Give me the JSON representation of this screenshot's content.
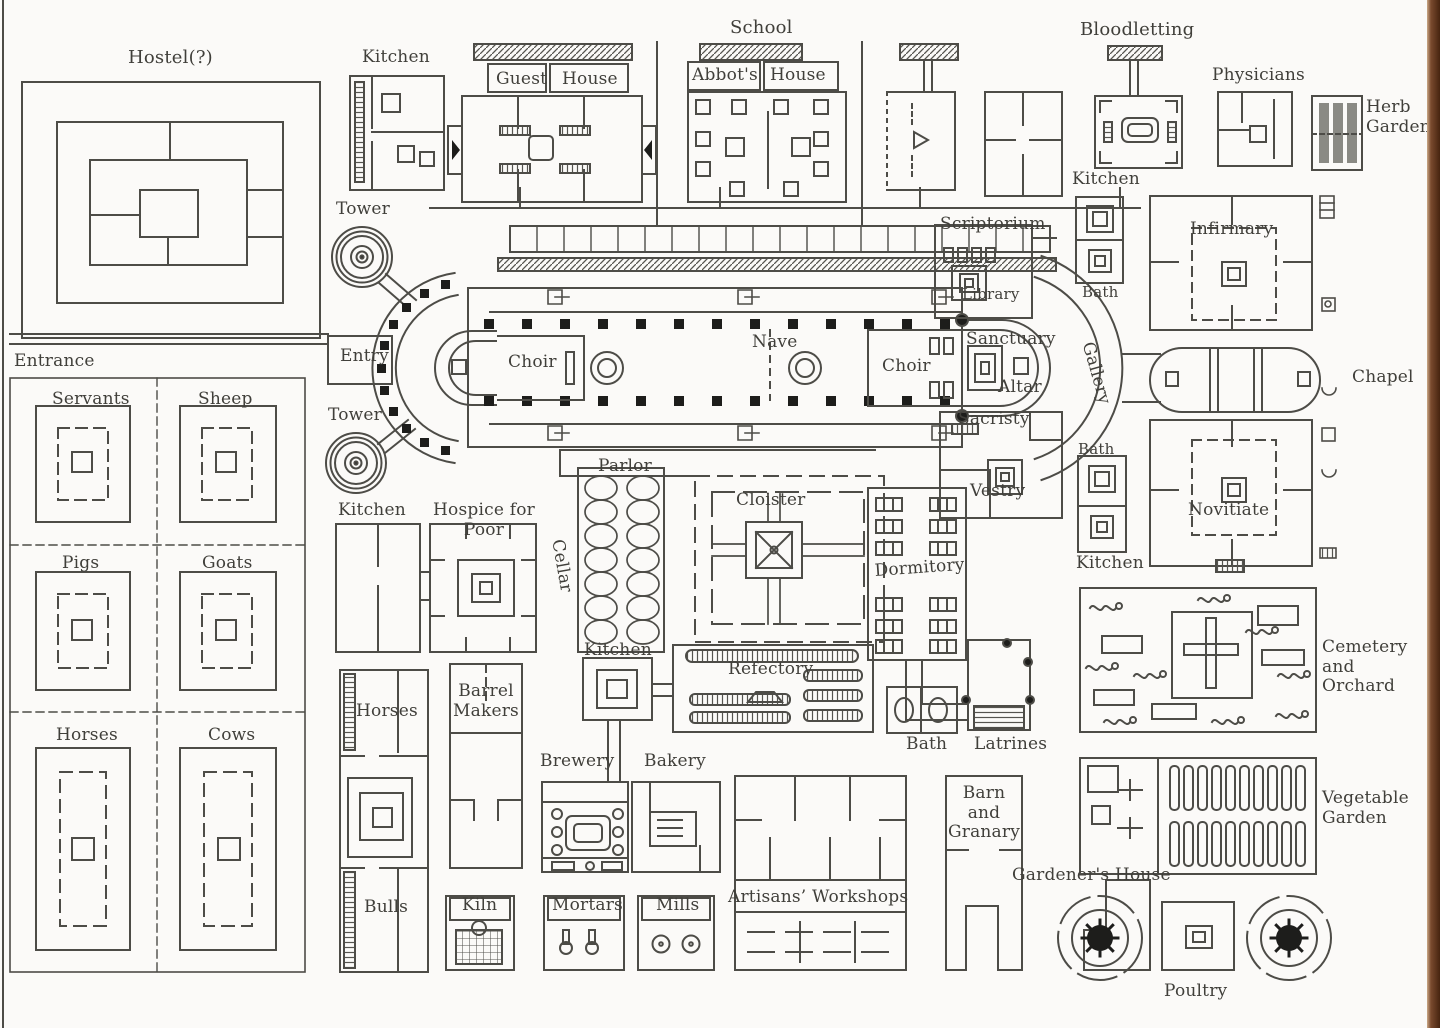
{
  "page": {
    "title": "Plan of a medieval monastery (Plan of Saint Gall)"
  },
  "colors": {
    "background": "#fbfaf8",
    "line": "#4d4c47",
    "label": "#403f3a",
    "solid_fill": "#1d1d1b",
    "edge_bar": "#46240f"
  },
  "labels": {
    "hostel": "Hostel(?)",
    "kitchen_tl": "Kitchen",
    "guest": "Guest",
    "guest_house": "House",
    "school": "School",
    "abbots": "Abbot's",
    "abbots_house": "House",
    "bloodletting": "Bloodletting",
    "physicians": "Physicians",
    "herb_garden": "Herb\nGarden",
    "kitchen_tr": "Kitchen",
    "scriptorium": "Scriptorium",
    "library": "Library",
    "bath1": "Bath",
    "infirmary": "Infirmary",
    "tower1": "Tower",
    "entry": "Entry",
    "tower2": "Tower",
    "entrance": "Entrance",
    "choir_w": "Choir",
    "nave": "Nave",
    "choir_e": "Choir",
    "sanctuary": "Sanctuary",
    "altar": "Altar",
    "gallery": "Gallery",
    "chapel": "Chapel",
    "sacristy": "Sacristy",
    "vestry": "Vestry",
    "bath2": "Bath",
    "novitiate": "Novitiate",
    "kitchen_r": "Kitchen",
    "servants": "Servants",
    "sheep": "Sheep",
    "pigs": "Pigs",
    "goats": "Goats",
    "horses_pen": "Horses",
    "cows": "Cows",
    "kitchen_l": "Kitchen",
    "hospice": "Hospice for\nPoor",
    "parlor": "Parlor",
    "cellar": "Cellar",
    "cloister": "Cloister",
    "dormitory": "Dormitory",
    "kitchen_m": "Kitchen",
    "refectory": "Refectory",
    "barrel_makers": "Barrel\nMakers",
    "horses_stable": "Horses",
    "bulls": "Bulls",
    "brewery": "Brewery",
    "bakery": "Bakery",
    "kiln": "Kiln",
    "mortars": "Mortars",
    "mills": "Mills",
    "artisans": "Artisans’ Workshops",
    "barn": "Barn and\nGranary",
    "bath3": "Bath",
    "latrines": "Latrines",
    "cemetery": "Cemetery\nand\nOrchard",
    "vegetable": "Vegetable\nGarden",
    "gardeners": "Gardener's House",
    "poultry": "Poultry"
  }
}
